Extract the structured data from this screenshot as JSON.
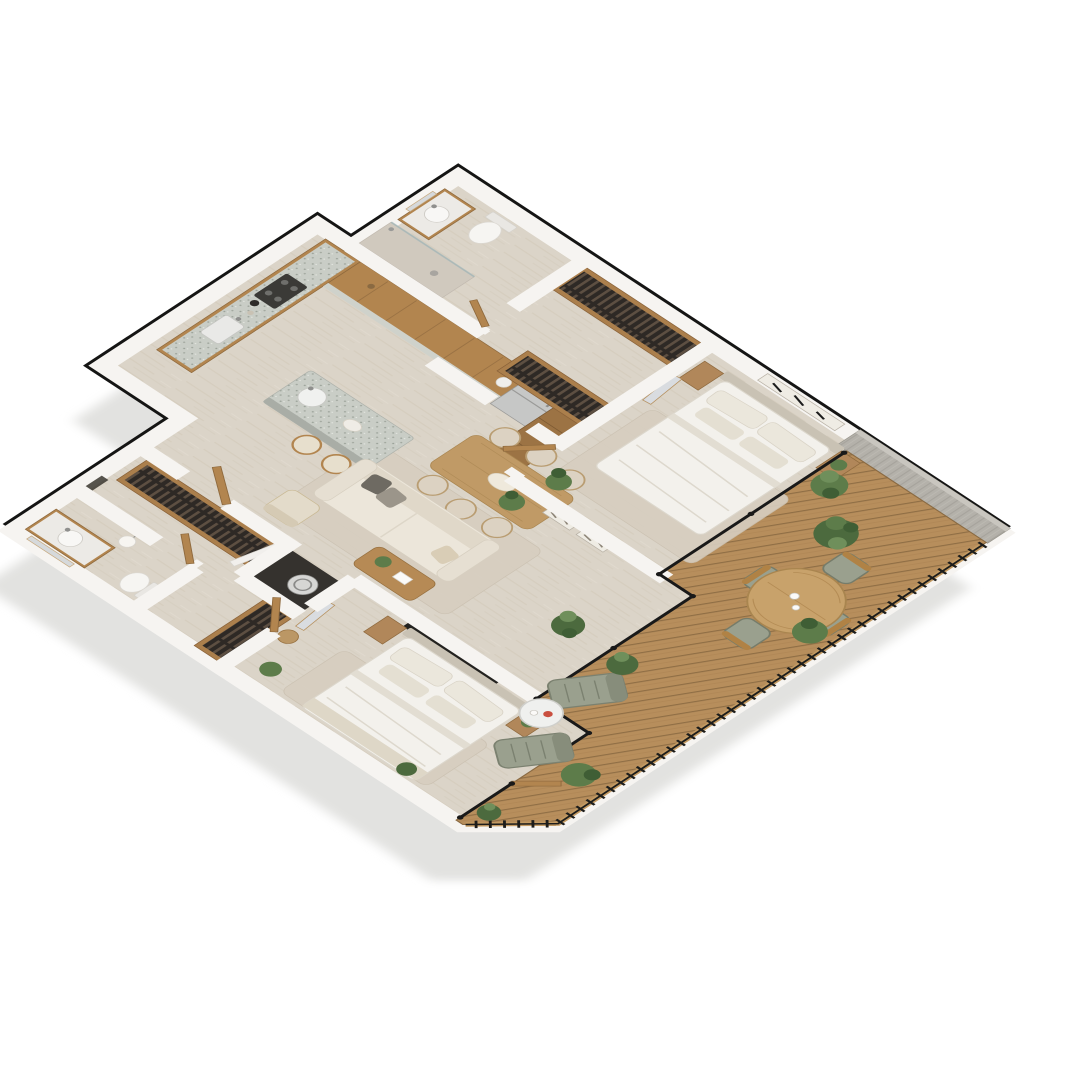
{
  "meta": {
    "title": "Isometric 3D floor plan of a two-bedroom apartment with wraparound wooden deck",
    "view": "axonometric top-down render, no text labels",
    "background": "#ffffff"
  },
  "palette": {
    "shadow_gray": "#e2e2e0",
    "outline_black": "#151514",
    "wall_white": "#f6f4f1",
    "floor_travertine": "#dbd4c8",
    "deck_wood": "#b78e5c",
    "deck_gap": "#8f6e45",
    "concrete_wall": "#b4b1aa",
    "cabinet_wood": "#b2854f",
    "table_wood": "#c09a66",
    "terrazzo_counter": "#c9cdc6",
    "upholstery_cream": "#ece6da",
    "bedding_white": "#f3f1ec",
    "headboard_taupe": "#c9c2b4",
    "rug_beige": "#d7cec0",
    "plant_green": "#5d7c4a",
    "plant_dark": "#3f5e35",
    "outdoor_sage": "#9aa08e",
    "glass_frame": "#191919",
    "appliance_steel": "#c6c7c6",
    "accent_red": "#c94f3f"
  },
  "rooms": [
    {
      "id": "bathroom-1",
      "name": "Bathroom 1",
      "furniture": [
        "toilet",
        "wood vanity with round sink",
        "wall mirror",
        "walk-in shower with drain"
      ]
    },
    {
      "id": "walk-in-closet-1",
      "name": "Walk-in closet 1",
      "furniture": [
        "wardrobe row with hanging clothes",
        "second wardrobe row with hanging clothes"
      ]
    },
    {
      "id": "bedroom-1",
      "name": "Bedroom 1",
      "furniture": [
        "double bed with white bedding",
        "two wood nightstands",
        "artwork above headboard",
        "leaning mirror",
        "potted plant",
        "area rug"
      ]
    },
    {
      "id": "kitchen",
      "name": "Kitchen",
      "furniture": [
        "L-shaped terrazzo counter",
        "cooktop and oven",
        "counter sink",
        "upper wood cabinets",
        "refrigerator",
        "tall pantry cabinet",
        "island with round sink",
        "two bar stools",
        "kettle and jars"
      ]
    },
    {
      "id": "living-dining",
      "name": "Living / dining room",
      "furniture": [
        "dining table",
        "six upholstered chairs",
        "oval centerpiece",
        "cream sofa with throw pillows",
        "armchair",
        "wood coffee table with plant and book",
        "area rug",
        "two framed artworks on half wall",
        "floor plant"
      ]
    },
    {
      "id": "hallway",
      "name": "Hallway",
      "furniture": [
        "wood interior doors"
      ]
    },
    {
      "id": "laundry-nook",
      "name": "Laundry nook",
      "furniture": [
        "washing machine",
        "white door"
      ]
    },
    {
      "id": "walk-in-closet-2",
      "name": "Walk-in closet 2",
      "furniture": [
        "long wardrobe row with hanging clothes",
        "corner wardrobe with hanging clothes",
        "dark bench strip"
      ]
    },
    {
      "id": "bathroom-2",
      "name": "Bathroom 2",
      "furniture": [
        "wood vanity with round sink",
        "framed mirror",
        "toilet",
        "pendant globe lamp"
      ]
    },
    {
      "id": "bedroom-2",
      "name": "Bedroom 2",
      "furniture": [
        "double bed with white bedding",
        "two wood nightstands",
        "wall TV",
        "leaning mirror",
        "woven basket",
        "potted plants",
        "area rug",
        "glass door to deck"
      ]
    },
    {
      "id": "terrace-deck",
      "name": "Terrace deck",
      "furniture": [
        "round outdoor dining table with two cups",
        "four sage outdoor chairs",
        "two sage sun loungers",
        "round side table with red cup",
        "six potted plants",
        "black metal railing with wood handrail",
        "concrete privacy wall",
        "black framed glass wall"
      ]
    }
  ]
}
